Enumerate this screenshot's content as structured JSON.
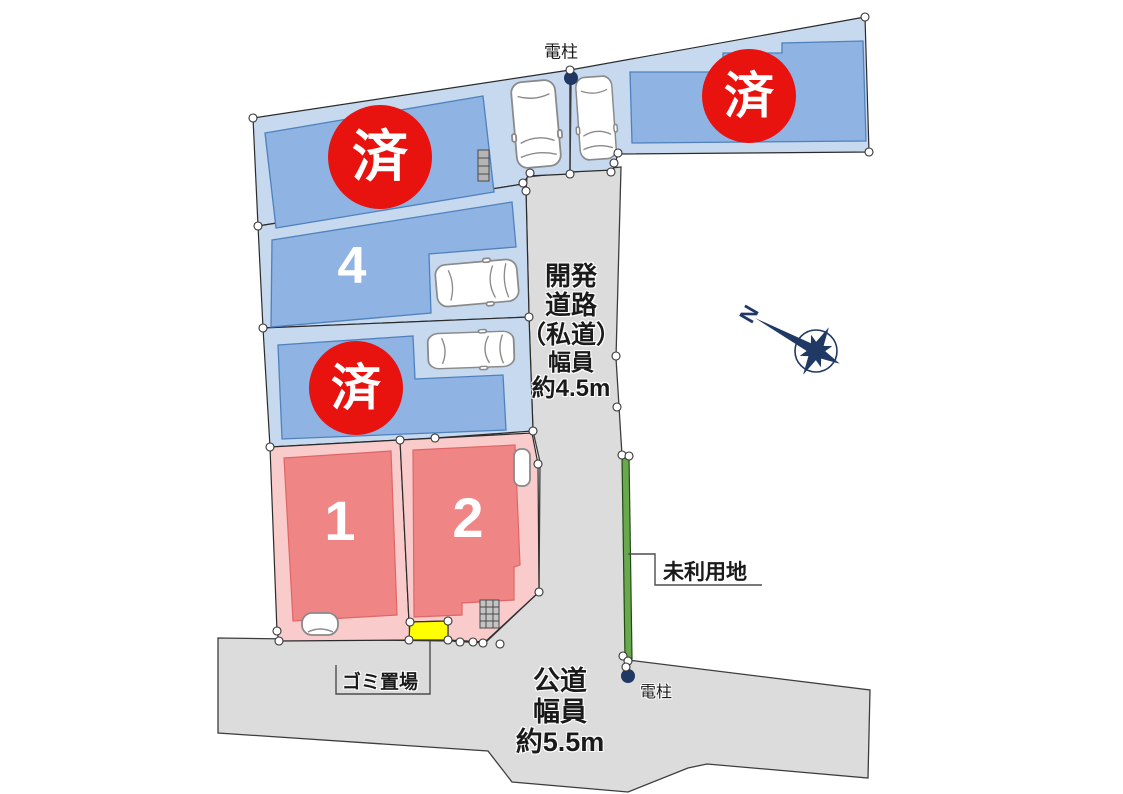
{
  "plan": {
    "lots": [
      {
        "name": "north-west",
        "status": "sold",
        "badge": "済"
      },
      {
        "name": "north-east",
        "status": "sold",
        "badge": "済"
      },
      {
        "name": "lot-4",
        "status": "for-sale",
        "number": "4"
      },
      {
        "name": "center-west",
        "status": "sold",
        "badge": "済"
      },
      {
        "name": "lot-1",
        "status": "for-sale",
        "number": "1"
      },
      {
        "name": "lot-2",
        "status": "for-sale",
        "number": "2"
      }
    ],
    "roads": {
      "private": {
        "lines": [
          "開発",
          "道路",
          "（私道）",
          "幅員",
          "約4.5m"
        ]
      },
      "public": {
        "lines": [
          "公道",
          "幅員",
          "約5.5m"
        ]
      }
    },
    "annotations": {
      "utility_pole_top": "電柱",
      "utility_pole_bottom": "電柱",
      "unused_land": "未利用地",
      "garbage_area": "ゴミ置場",
      "compass_north": "N"
    },
    "colors": {
      "lot_sold_fill": "#c7d9ef",
      "building_sold_fill": "#8fb3e2",
      "lot_sale_fill": "#f9cbcb",
      "building_sale_fill": "#ef8585",
      "sold_badge": "#e8120f",
      "road_fill": "#dcdcdc",
      "unused_land_marker": "#6aa84f",
      "garbage_marker": "#ffff00",
      "pole_marker": "#1f3864",
      "compass": "#1f3864"
    }
  }
}
